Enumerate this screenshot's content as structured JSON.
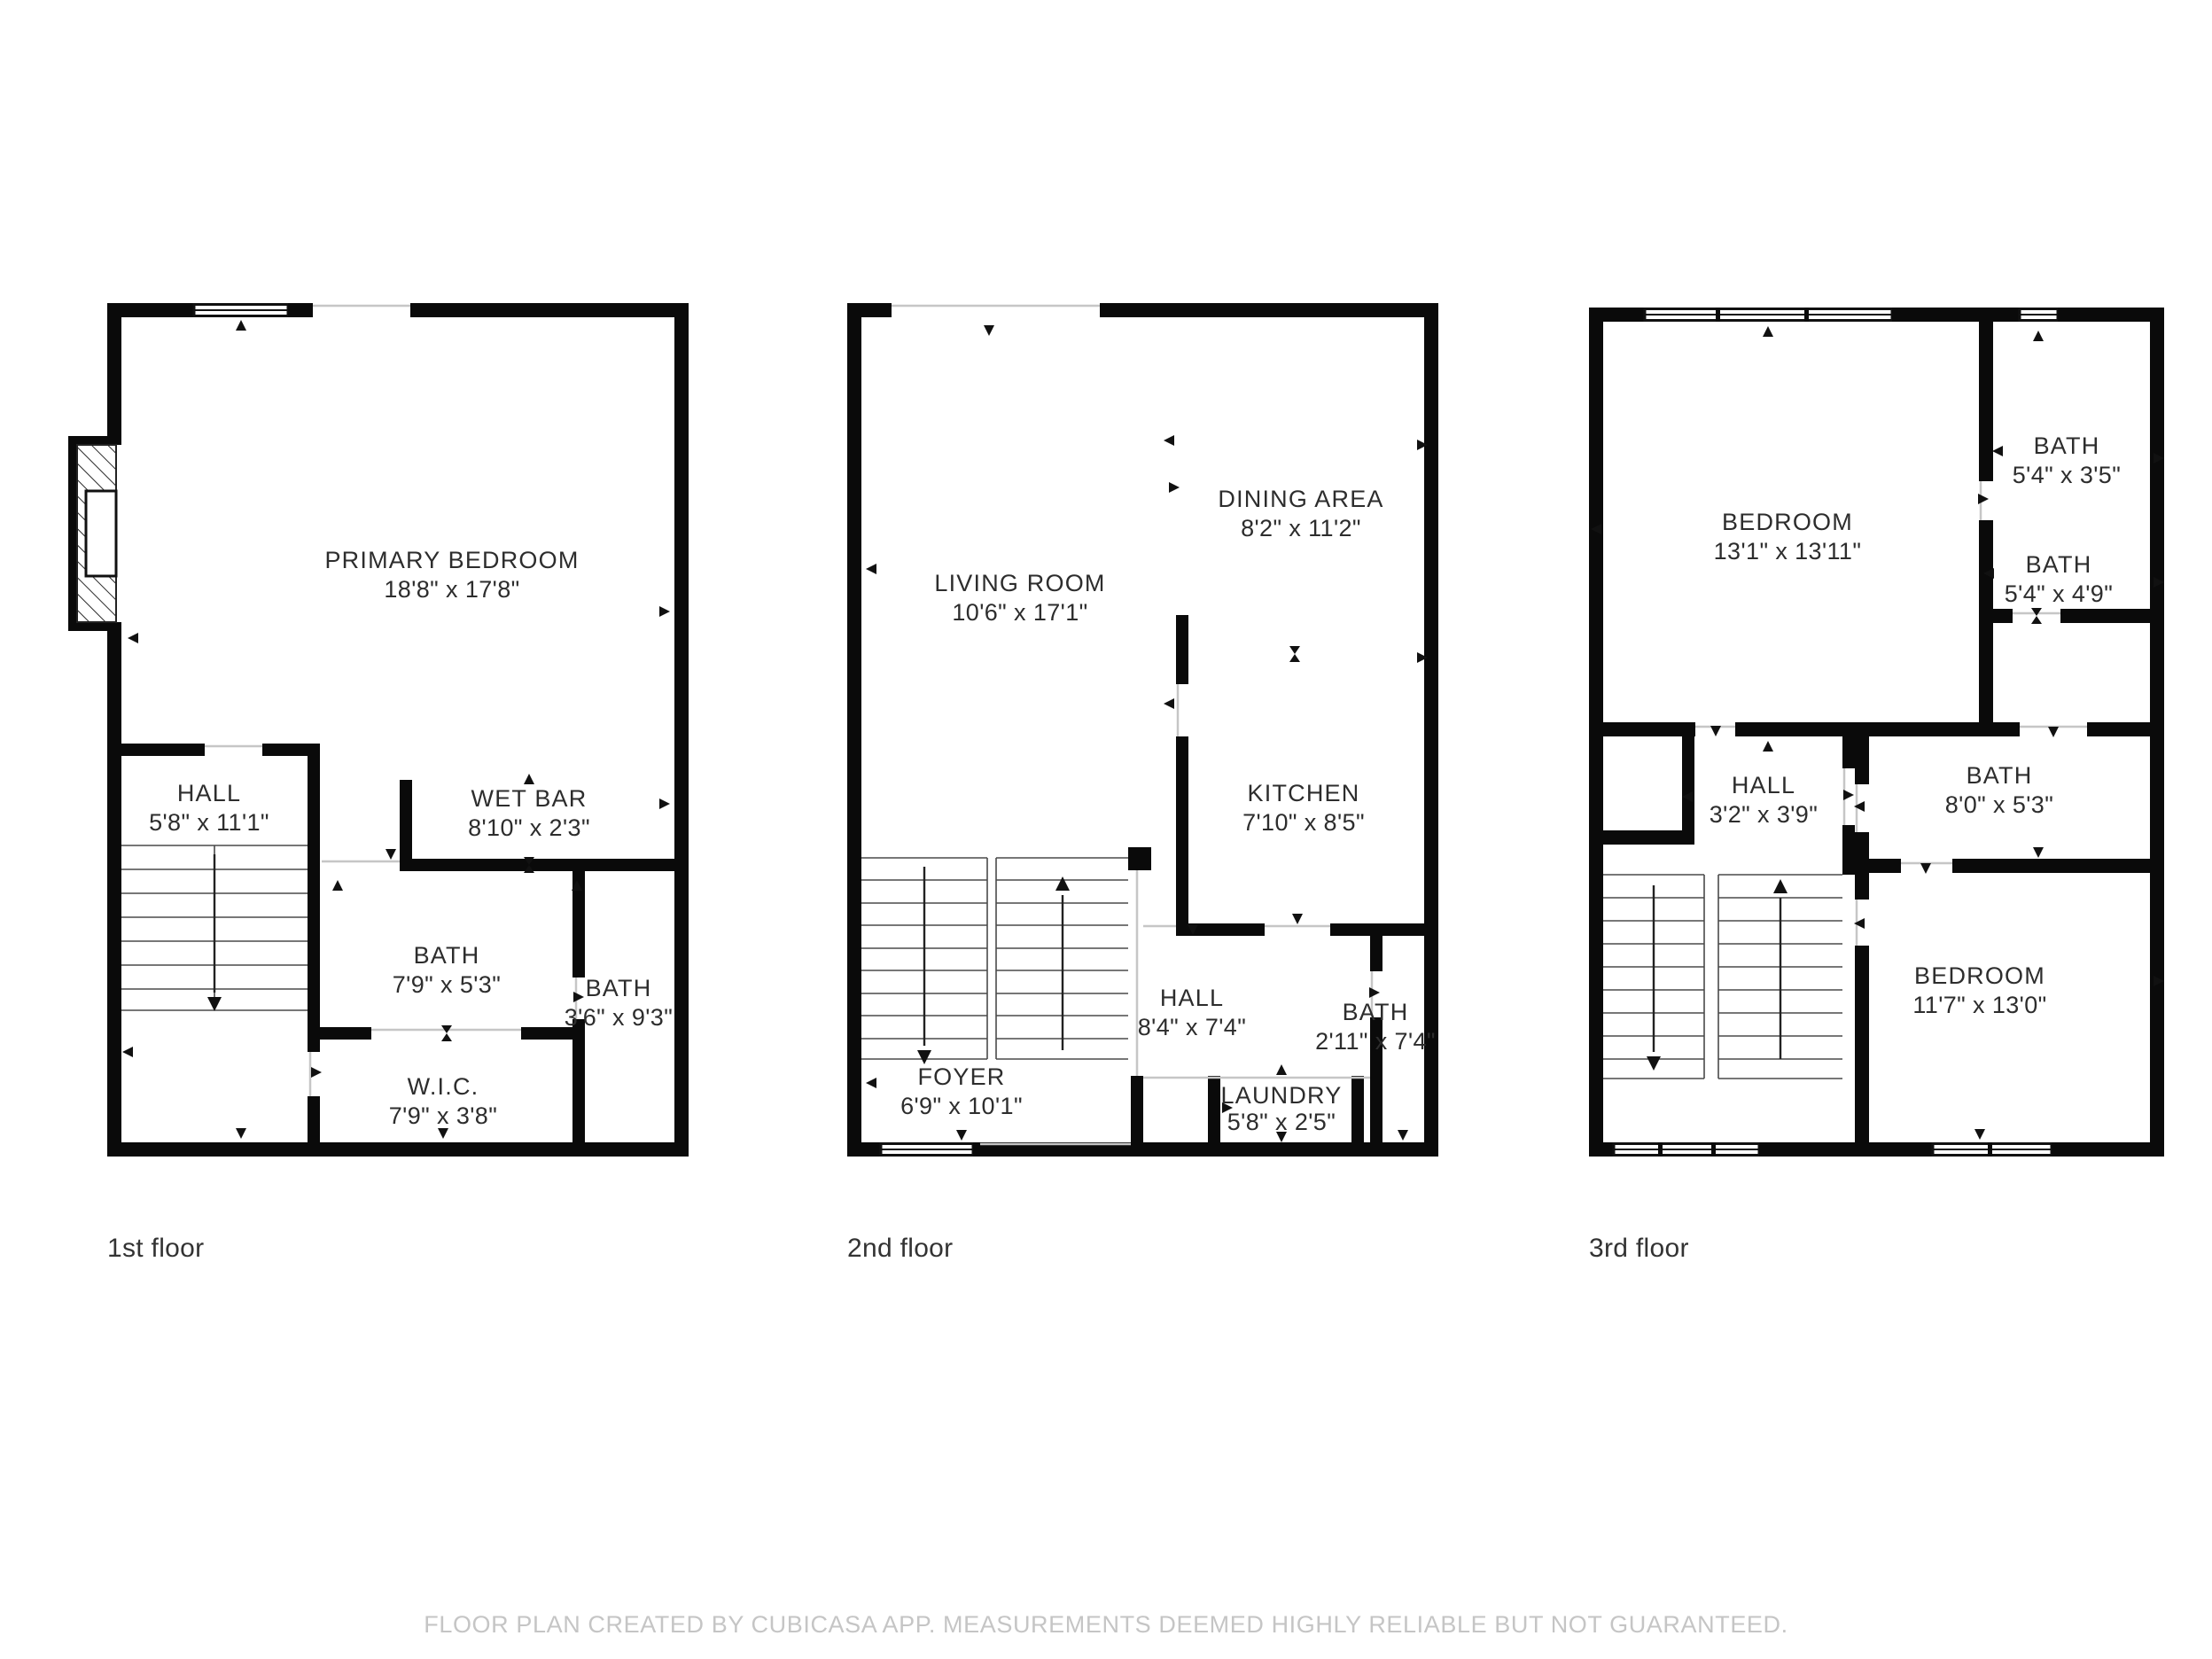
{
  "footer": {
    "text": "FLOOR PLAN CREATED BY CUBICASA APP. MEASUREMENTS DEEMED HIGHLY RELIABLE BUT NOT GUARANTEED."
  },
  "colors": {
    "wall": "#0a0a0a",
    "opening": "#c6c6c6",
    "label": "#2d2d2d",
    "footer": "#c5c5c5"
  },
  "floors": [
    {
      "label": "1st floor",
      "rooms": [
        {
          "name": "PRIMARY BEDROOM",
          "dims": "18'8\" x 17'8\""
        },
        {
          "name": "HALL",
          "dims": "5'8\" x 11'1\""
        },
        {
          "name": "WET BAR",
          "dims": "8'10\" x 2'3\""
        },
        {
          "name": "BATH",
          "dims": "7'9\" x 5'3\""
        },
        {
          "name": "BATH",
          "dims": "3'6\" x 9'3\""
        },
        {
          "name": "W.I.C.",
          "dims": "7'9\" x 3'8\""
        }
      ]
    },
    {
      "label": "2nd floor",
      "rooms": [
        {
          "name": "LIVING ROOM",
          "dims": "10'6\" x 17'1\""
        },
        {
          "name": "DINING AREA",
          "dims": "8'2\" x 11'2\""
        },
        {
          "name": "KITCHEN",
          "dims": "7'10\" x 8'5\""
        },
        {
          "name": "HALL",
          "dims": "8'4\" x 7'4\""
        },
        {
          "name": "BATH",
          "dims": "2'11\" x 7'4\""
        },
        {
          "name": "FOYER",
          "dims": "6'9\" x 10'1\""
        },
        {
          "name": "LAUNDRY",
          "dims": "5'8\" x 2'5\""
        }
      ]
    },
    {
      "label": "3rd floor",
      "rooms": [
        {
          "name": "BEDROOM",
          "dims": "13'1\" x 13'11\""
        },
        {
          "name": "BATH",
          "dims": "5'4\" x 3'5\""
        },
        {
          "name": "BATH",
          "dims": "5'4\" x 4'9\""
        },
        {
          "name": "BATH",
          "dims": "8'0\" x 5'3\""
        },
        {
          "name": "HALL",
          "dims": "3'2\" x 3'9\""
        },
        {
          "name": "BEDROOM",
          "dims": "11'7\" x 13'0\""
        }
      ]
    }
  ]
}
